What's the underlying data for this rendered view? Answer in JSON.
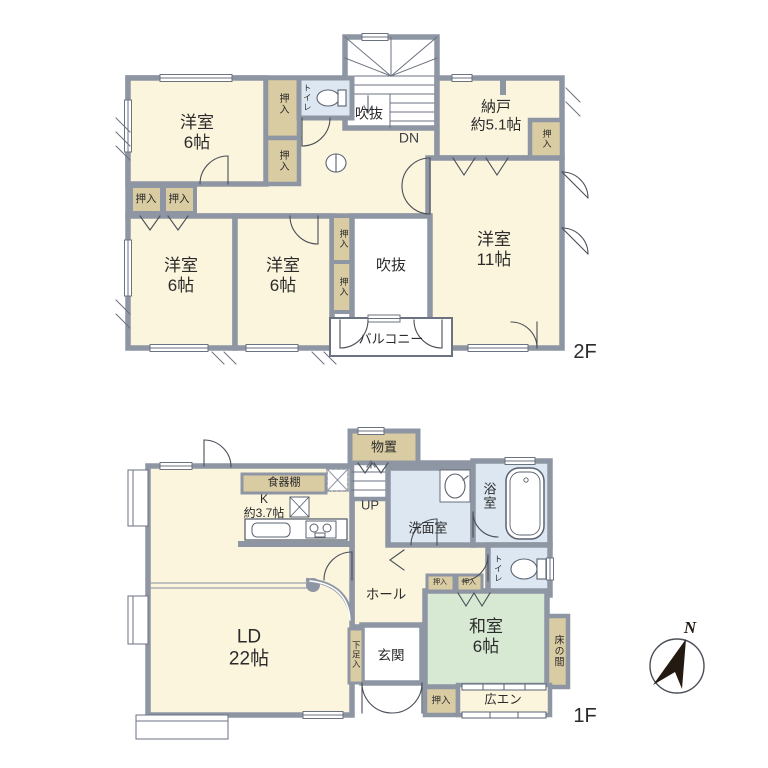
{
  "title": "2-story house floor plan",
  "colors": {
    "wall": "#8e96a4",
    "room_cream": "#fcf5de",
    "closet_tan": "#d9cba2",
    "wet_blue": "#dde7f2",
    "tatami_green": "#d7e8d3",
    "white": "#ffffff"
  },
  "floor2": {
    "label": "2F",
    "rooms": {
      "yoshitsu_nw": "洋室\n6帖",
      "yoshitsu_sw": "洋室\n6帖",
      "yoshitsu_s": "洋室\n6帖",
      "yoshitsu_e": "洋室\n11帖",
      "nando": "納戸\n約5.1帖",
      "fukinuke_stairs": "吹抜",
      "fukinuke_void": "吹抜",
      "dn": "DN",
      "balcony": "バルコニー",
      "toilet": "トイレ",
      "oshiire": "押入"
    }
  },
  "floor1": {
    "label": "1F",
    "rooms": {
      "ld": "LD\n22帖",
      "kitchen": "K\n約3.7帖",
      "shokkidana": "食器棚",
      "monooki": "物置",
      "up": "UP",
      "senmenshitsu": "洗面室",
      "yokushitsu": "浴室",
      "toilet": "トイレ",
      "hall": "ホール",
      "washitsu": "和室\n6帖",
      "tokonoma": "床の間",
      "hiroen": "広エン",
      "genkan": "玄関",
      "kutsubako": "下足入",
      "oshiire": "押入"
    }
  },
  "compass": {
    "north": "N"
  }
}
